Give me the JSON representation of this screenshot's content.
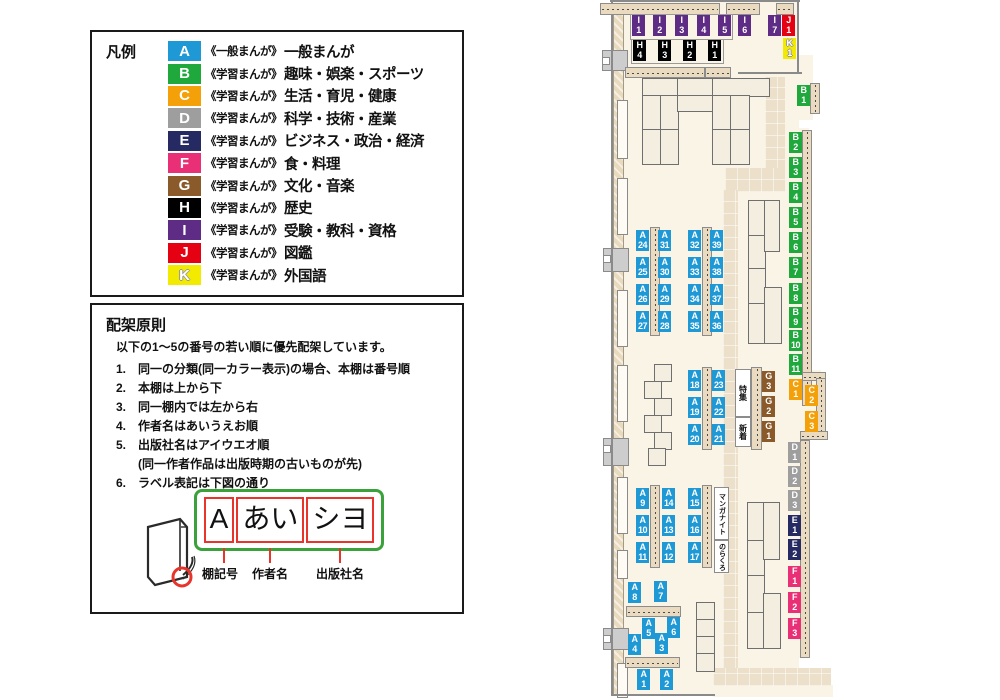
{
  "legend": {
    "title": "凡例",
    "items": [
      {
        "code": "A",
        "series": "《一般まんが》",
        "label": "一般まんが"
      },
      {
        "code": "B",
        "series": "《学習まんが》",
        "label": "趣味・娯楽・スポーツ"
      },
      {
        "code": "C",
        "series": "《学習まんが》",
        "label": "生活・育児・健康"
      },
      {
        "code": "D",
        "series": "《学習まんが》",
        "label": "科学・技術・産業"
      },
      {
        "code": "E",
        "series": "《学習まんが》",
        "label": "ビジネス・政治・経済"
      },
      {
        "code": "F",
        "series": "《学習まんが》",
        "label": "食・料理"
      },
      {
        "code": "G",
        "series": "《学習まんが》",
        "label": "文化・音楽"
      },
      {
        "code": "H",
        "series": "《学習まんが》",
        "label": "歴史"
      },
      {
        "code": "I",
        "series": "《学習まんが》",
        "label": "受験・教科・資格"
      },
      {
        "code": "J",
        "series": "《学習まんが》",
        "label": "図鑑"
      },
      {
        "code": "K",
        "series": "《学習まんが》",
        "label": "外国語"
      }
    ]
  },
  "principles": {
    "title": "配架原則",
    "intro": "以下の1〜5の番号の若い順に優先配架しています。",
    "rules": [
      {
        "num": "1.",
        "text": "同一の分類(同一カラー表示)の場合、本棚は番号順"
      },
      {
        "num": "2.",
        "text": "本棚は上から下"
      },
      {
        "num": "3.",
        "text": "同一棚内では左から右"
      },
      {
        "num": "4.",
        "text": "作者名はあいうえお順"
      },
      {
        "num": "5.",
        "text": "出版社名はアイウエオ順"
      },
      {
        "num": "",
        "text": "(同一作者作品は出版時期の古いものが先)"
      },
      {
        "num": "6.",
        "text": "ラベル表記は下図の通り"
      }
    ],
    "diagram": {
      "boxes": [
        "A",
        "あい",
        "シヨ"
      ],
      "labels": [
        "棚記号",
        "作者名",
        "出版社名"
      ]
    }
  },
  "map": {
    "colors": {
      "A": "#1F99D5",
      "B": "#1FA83C",
      "C": "#F3A009",
      "D": "#9E9E9E",
      "E": "#252A63",
      "F": "#E93077",
      "G": "#8A5A2B",
      "H": "#000000",
      "I": "#5E2B85",
      "J": "#E50012",
      "K": "#F2EB00"
    },
    "chips": [
      {
        "c": "I",
        "n": "1",
        "x": 44,
        "y": 15
      },
      {
        "c": "I",
        "n": "2",
        "x": 65,
        "y": 15
      },
      {
        "c": "I",
        "n": "3",
        "x": 87,
        "y": 15
      },
      {
        "c": "I",
        "n": "4",
        "x": 109,
        "y": 15
      },
      {
        "c": "I",
        "n": "5",
        "x": 130,
        "y": 15
      },
      {
        "c": "I",
        "n": "6",
        "x": 150,
        "y": 15
      },
      {
        "c": "I",
        "n": "7",
        "x": 180,
        "y": 15
      },
      {
        "c": "J",
        "n": "1",
        "x": 194,
        "y": 15
      },
      {
        "c": "K",
        "n": "1",
        "x": 195,
        "y": 38
      },
      {
        "c": "H",
        "n": "4",
        "x": 45,
        "y": 40
      },
      {
        "c": "H",
        "n": "3",
        "x": 70,
        "y": 40
      },
      {
        "c": "H",
        "n": "2",
        "x": 95,
        "y": 40
      },
      {
        "c": "H",
        "n": "1",
        "x": 120,
        "y": 40
      },
      {
        "c": "B",
        "n": "1",
        "x": 209,
        "y": 85
      },
      {
        "c": "B",
        "n": "2",
        "x": 201,
        "y": 132
      },
      {
        "c": "B",
        "n": "3",
        "x": 201,
        "y": 157
      },
      {
        "c": "B",
        "n": "4",
        "x": 201,
        "y": 182
      },
      {
        "c": "B",
        "n": "5",
        "x": 201,
        "y": 207
      },
      {
        "c": "B",
        "n": "6",
        "x": 201,
        "y": 232
      },
      {
        "c": "B",
        "n": "7",
        "x": 201,
        "y": 257
      },
      {
        "c": "B",
        "n": "8",
        "x": 201,
        "y": 283
      },
      {
        "c": "B",
        "n": "9",
        "x": 201,
        "y": 307
      },
      {
        "c": "B",
        "n": "10",
        "x": 201,
        "y": 330
      },
      {
        "c": "B",
        "n": "11",
        "x": 201,
        "y": 354
      },
      {
        "c": "C",
        "n": "1",
        "x": 201,
        "y": 379
      },
      {
        "c": "C",
        "n": "2",
        "x": 217,
        "y": 385
      },
      {
        "c": "C",
        "n": "3",
        "x": 217,
        "y": 411
      },
      {
        "c": "D",
        "n": "1",
        "x": 200,
        "y": 442
      },
      {
        "c": "D",
        "n": "2",
        "x": 200,
        "y": 466
      },
      {
        "c": "D",
        "n": "3",
        "x": 200,
        "y": 490
      },
      {
        "c": "E",
        "n": "1",
        "x": 200,
        "y": 515
      },
      {
        "c": "E",
        "n": "2",
        "x": 200,
        "y": 539
      },
      {
        "c": "F",
        "n": "1",
        "x": 200,
        "y": 566
      },
      {
        "c": "F",
        "n": "2",
        "x": 200,
        "y": 592
      },
      {
        "c": "F",
        "n": "3",
        "x": 200,
        "y": 618
      },
      {
        "c": "A",
        "n": "24",
        "x": 48,
        "y": 230
      },
      {
        "c": "A",
        "n": "25",
        "x": 48,
        "y": 257
      },
      {
        "c": "A",
        "n": "26",
        "x": 48,
        "y": 284
      },
      {
        "c": "A",
        "n": "27",
        "x": 48,
        "y": 311
      },
      {
        "c": "A",
        "n": "31",
        "x": 70,
        "y": 230
      },
      {
        "c": "A",
        "n": "30",
        "x": 70,
        "y": 257
      },
      {
        "c": "A",
        "n": "29",
        "x": 70,
        "y": 284
      },
      {
        "c": "A",
        "n": "28",
        "x": 70,
        "y": 311
      },
      {
        "c": "A",
        "n": "32",
        "x": 100,
        "y": 230
      },
      {
        "c": "A",
        "n": "33",
        "x": 100,
        "y": 257
      },
      {
        "c": "A",
        "n": "34",
        "x": 100,
        "y": 284
      },
      {
        "c": "A",
        "n": "35",
        "x": 100,
        "y": 311
      },
      {
        "c": "A",
        "n": "39",
        "x": 122,
        "y": 230
      },
      {
        "c": "A",
        "n": "38",
        "x": 122,
        "y": 257
      },
      {
        "c": "A",
        "n": "37",
        "x": 122,
        "y": 284
      },
      {
        "c": "A",
        "n": "36",
        "x": 122,
        "y": 311
      },
      {
        "c": "A",
        "n": "18",
        "x": 100,
        "y": 370
      },
      {
        "c": "A",
        "n": "19",
        "x": 100,
        "y": 397
      },
      {
        "c": "A",
        "n": "20",
        "x": 100,
        "y": 424
      },
      {
        "c": "A",
        "n": "23",
        "x": 124,
        "y": 370
      },
      {
        "c": "A",
        "n": "22",
        "x": 124,
        "y": 397
      },
      {
        "c": "A",
        "n": "21",
        "x": 124,
        "y": 424
      },
      {
        "c": "G",
        "n": "3",
        "x": 174,
        "y": 371
      },
      {
        "c": "G",
        "n": "2",
        "x": 174,
        "y": 396
      },
      {
        "c": "G",
        "n": "1",
        "x": 174,
        "y": 421
      },
      {
        "c": "A",
        "n": "9",
        "x": 48,
        "y": 488
      },
      {
        "c": "A",
        "n": "10",
        "x": 48,
        "y": 515
      },
      {
        "c": "A",
        "n": "11",
        "x": 48,
        "y": 542
      },
      {
        "c": "A",
        "n": "14",
        "x": 74,
        "y": 488
      },
      {
        "c": "A",
        "n": "13",
        "x": 74,
        "y": 515
      },
      {
        "c": "A",
        "n": "12",
        "x": 74,
        "y": 542
      },
      {
        "c": "A",
        "n": "15",
        "x": 100,
        "y": 488
      },
      {
        "c": "A",
        "n": "16",
        "x": 100,
        "y": 515
      },
      {
        "c": "A",
        "n": "17",
        "x": 100,
        "y": 542
      },
      {
        "c": "A",
        "n": "8",
        "x": 40,
        "y": 582
      },
      {
        "c": "A",
        "n": "7",
        "x": 66,
        "y": 581
      },
      {
        "c": "A",
        "n": "5",
        "x": 54,
        "y": 618
      },
      {
        "c": "A",
        "n": "6",
        "x": 79,
        "y": 617
      },
      {
        "c": "A",
        "n": "4",
        "x": 40,
        "y": 634
      },
      {
        "c": "A",
        "n": "3",
        "x": 67,
        "y": 633
      },
      {
        "c": "A",
        "n": "1",
        "x": 49,
        "y": 669
      },
      {
        "c": "A",
        "n": "2",
        "x": 72,
        "y": 669
      }
    ],
    "features": [
      {
        "text": "特集",
        "x": 147,
        "y": 369,
        "w": 14,
        "h": 46,
        "fs": 8
      },
      {
        "text": "新着",
        "x": 147,
        "y": 417,
        "w": 14,
        "h": 28,
        "fs": 8
      },
      {
        "text": "マンガナイト",
        "x": 126,
        "y": 487,
        "w": 13,
        "h": 51,
        "fs": 7
      },
      {
        "text": "のらくろ",
        "x": 126,
        "y": 540,
        "w": 13,
        "h": 31,
        "fs": 7
      }
    ]
  }
}
